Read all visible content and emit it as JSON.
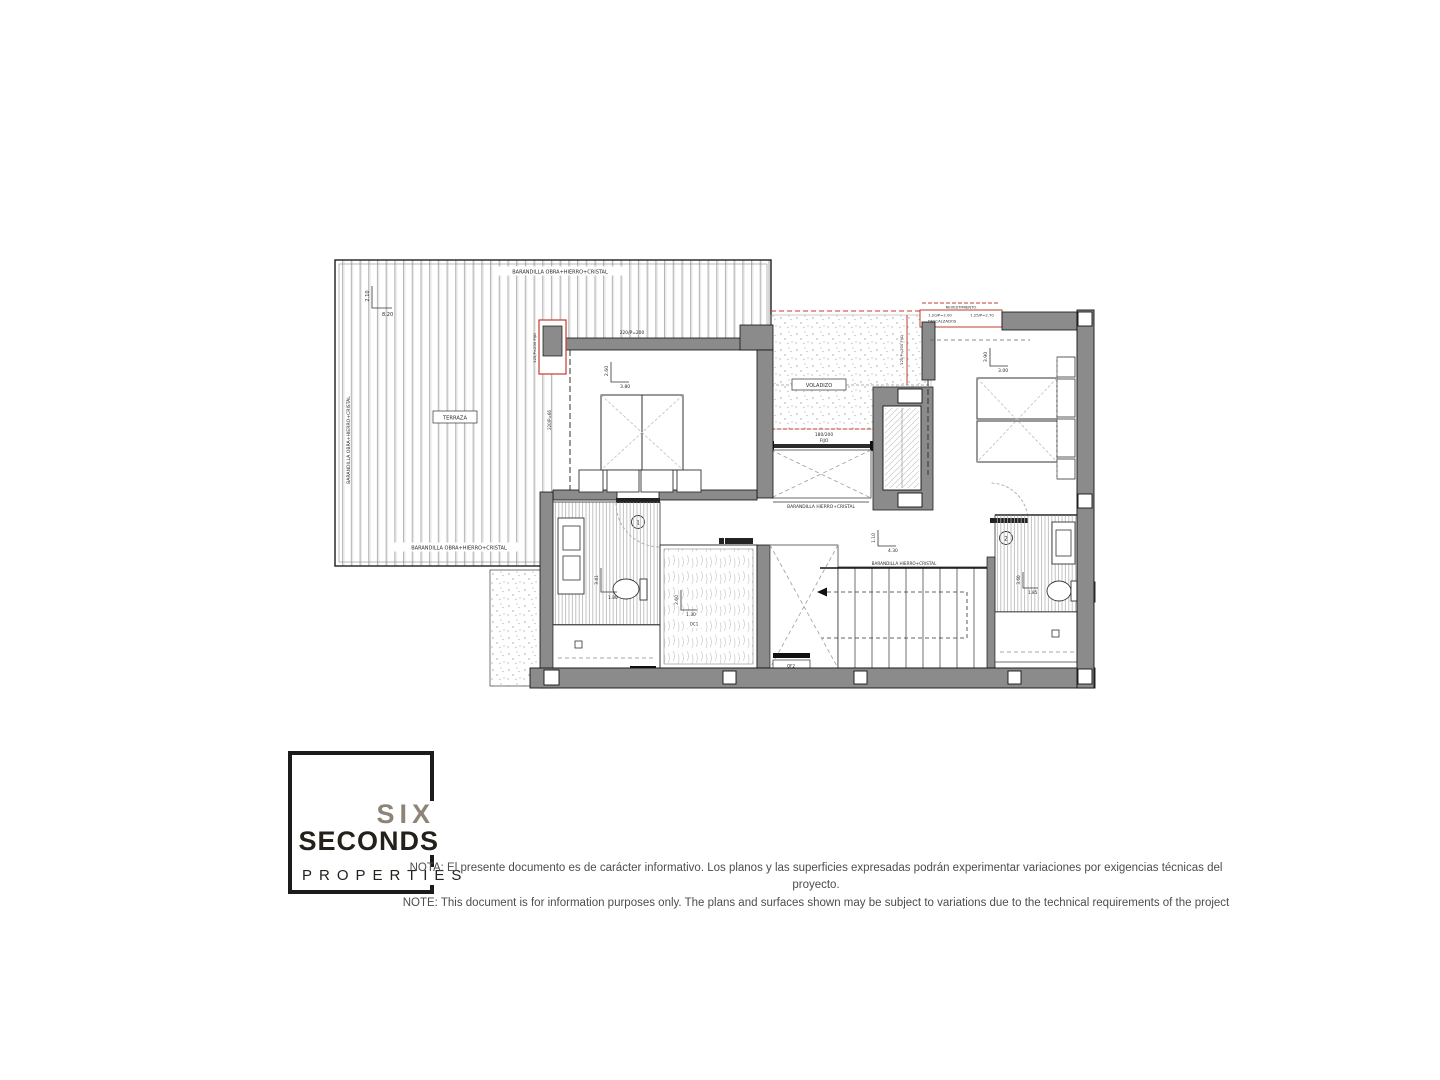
{
  "colors": {
    "wall": "#8b8b8b",
    "line": "#222222",
    "red": "#c63b2e",
    "logo_accent": "#8d8376",
    "logo_dark": "#24211b",
    "note_text": "#4d4d4d"
  },
  "plan": {
    "rooms": {
      "bedroom1_number": "1",
      "bedroom2_number": "2"
    },
    "labels": {
      "terraza": "TERRAZA",
      "voladizo": "VOLADIZO",
      "barandilla_obra": "BARANDILLA OBRA+HIERRO+CRISTAL",
      "barandilla_hierro": "BARANDILLA HIERRO+CRISTAL",
      "mampara": "MAMPARA",
      "revestimiento": "REVESTIMIENTO",
      "descalzados_line1": "1.20/P=2.00",
      "descalzados_line2": "DESCALZADOS",
      "spec_125": "1.25/P=2.70",
      "fijo_size": "180/200",
      "fijo": "FIJO",
      "spec_220_200": "220/P=200",
      "spec_220_66": "220/P=66",
      "spec_120_fijo": "120/P=200 FIJO",
      "of2_code": "OF2",
      "of2_size": "80/200",
      "of1_code": "OF1",
      "oc1_code": "OC1"
    },
    "dimensions": {
      "terraza": {
        "v": "2.10",
        "h": "8.20"
      },
      "bedroom1": {
        "v": "2.60",
        "h": "3.80"
      },
      "bedroom2": {
        "v": "3.90",
        "h": "3.00"
      },
      "bath1": {
        "v": "3.41",
        "h": "1.80"
      },
      "bath2": {
        "v": "3.60",
        "h": "1.85"
      },
      "closet": {
        "v": "2.60",
        "h": "1.30"
      },
      "stairs": {
        "v": "1.10",
        "h": "4.30"
      }
    }
  },
  "logo": {
    "six": "SIX",
    "seconds": "SECONDS",
    "properties": "PROPERTIES"
  },
  "disclaimer": {
    "line1": "NOTA: El presente documento es de carácter informativo. Los planos y las superficies expresadas podrán experimentar variaciones por exigencias técnicas del proyecto.",
    "line2": "NOTE: This document is for information purposes only. The plans and surfaces shown may be subject to variations due to the technical requirements of the project"
  }
}
